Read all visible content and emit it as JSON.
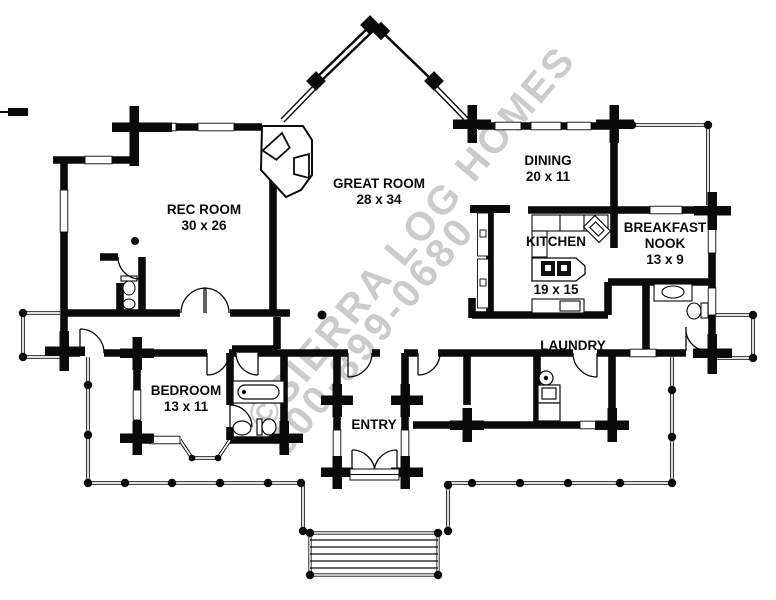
{
  "plan": {
    "title": "Log home single-story floor plan",
    "rooms": {
      "rec": {
        "name": "REC ROOM",
        "dims": "30 x 26"
      },
      "great": {
        "name": "GREAT ROOM",
        "dims": "28 x 34"
      },
      "dining": {
        "name": "DINING",
        "dims": "20 x 11"
      },
      "kitchen": {
        "name": "KITCHEN",
        "dims": "19 x 15"
      },
      "nook": {
        "name": "BREAKFAST NOOK",
        "dims": "13 x 9"
      },
      "laundry": {
        "name": "LAUNDRY",
        "dims": ""
      },
      "bedroom": {
        "name": "BEDROOM",
        "dims": "13 x 11"
      },
      "entry": {
        "name": "ENTRY",
        "dims": ""
      }
    },
    "watermark": {
      "line1": "©SIERRA LOG HOMES",
      "line2": "800-899-0680",
      "color": "#bfbfbf"
    },
    "colors": {
      "walls": "#0a0a0a",
      "background": "#ffffff"
    }
  }
}
